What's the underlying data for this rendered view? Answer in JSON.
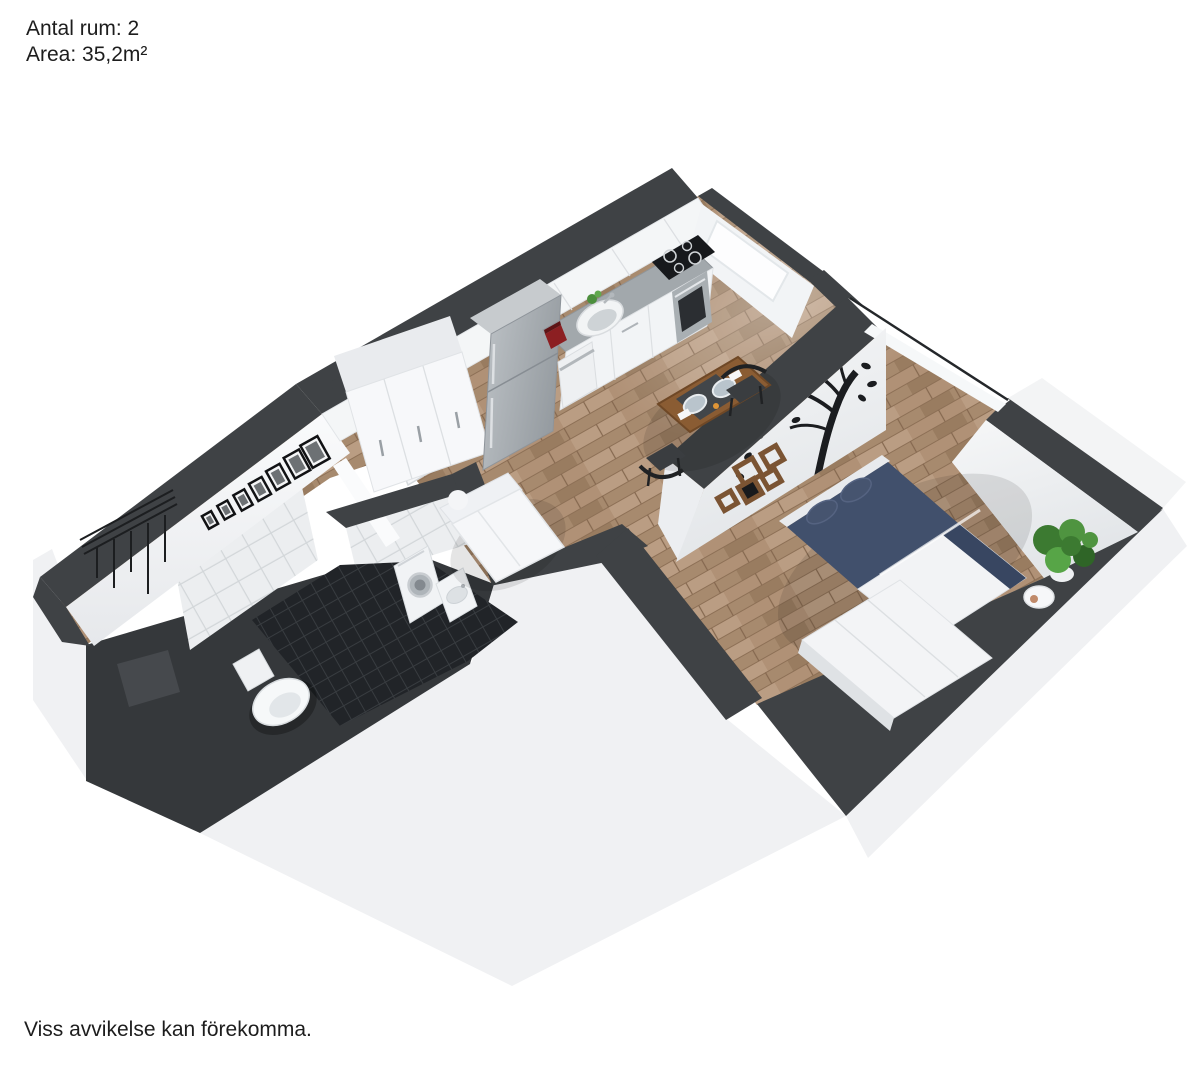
{
  "header": {
    "line1": "Antal rum: 2",
    "line2": "Area: 35,2m²"
  },
  "footer": {
    "disclaimer": "Viss avvikelse kan förekomma."
  },
  "palette": {
    "background": "#ffffff",
    "wall_top": "#3f4245",
    "wall_shadow": "#35383b",
    "wall_face": "#f4f5f7",
    "slab": "#f0f1f3",
    "floor_wood": "#b09176",
    "bathroom_tile_dark": "#202225",
    "bathroom_tile_light": "#edeff1",
    "counter": "#a2a8ac",
    "bed_navy": "#41506c",
    "duvet_white": "#f2f3f5",
    "table_wood": "#8a5c33",
    "shelf_brown": "#7b5433",
    "decor_black": "#1b1d20",
    "plant_green": "#4c8f3d"
  }
}
